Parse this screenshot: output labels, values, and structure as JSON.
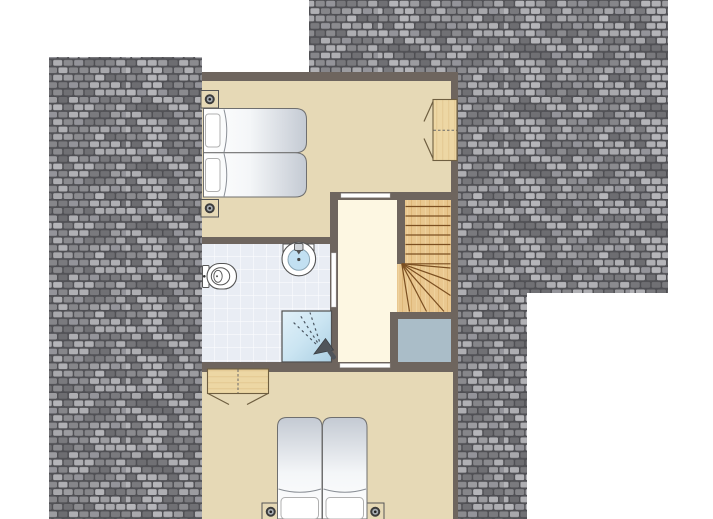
{
  "canvas": {
    "width": 713,
    "height": 519
  },
  "scene": {
    "type": "architectural-floor-plan",
    "description": "Top floor (attic) plan of a holiday house seen from above, surrounded by grey roof tiling. Two bedrooms, a bathroom, a landing and a winder staircase.",
    "rooms": [
      {
        "id": "bedroom-top",
        "label": "bedroom with two single beds and wardrobe"
      },
      {
        "id": "bathroom",
        "label": "bathroom with toilet, washbasin and shower"
      },
      {
        "id": "landing",
        "label": "landing / hallway"
      },
      {
        "id": "staircase",
        "label": "winder staircase going down"
      },
      {
        "id": "stairwell-void",
        "label": "stair void"
      },
      {
        "id": "bedroom-bottom",
        "label": "bedroom with double bed and wardrobe"
      }
    ],
    "furniture": [
      {
        "id": "twin-beds",
        "label": "two single beds side by side"
      },
      {
        "id": "wardrobe-top",
        "label": "wardrobe with open doors"
      },
      {
        "id": "toilet",
        "label": "toilet"
      },
      {
        "id": "washbasin",
        "label": "washbasin"
      },
      {
        "id": "shower",
        "label": "shower with spray symbol"
      },
      {
        "id": "wardrobe-bottom",
        "label": "wardrobe with open doors"
      },
      {
        "id": "double-bed",
        "label": "double bed (two mattresses)"
      },
      {
        "id": "spotlights",
        "label": "four ceiling spotlights"
      }
    ]
  },
  "colors": {
    "background": "#ffffff",
    "wall": "#6e655e",
    "bedroom_floor": "#e6d9b6",
    "landing_floor": "#fdf7e2",
    "bathroom_tile": "#e9edf4",
    "tile_grout": "#fbfcfe",
    "stair_wood": "#e9c78f",
    "stair_line": "#7b4f21",
    "wardrobe_wood": "#edd7a4",
    "wardrobe_grain": "#dcbc83",
    "wardrobe_edge": "#6f5f41",
    "shower_blue_light": "#e2f1f9",
    "shower_blue_dark": "#abcfe3",
    "sink_water": "#c2e0f2",
    "stairwell_void": "#aabdc8",
    "mattress_light": "#ffffff",
    "mattress_dark": "#c4cad3",
    "mattress_edge": "#6f6f6f",
    "pillow_edge": "#b0b0b0",
    "duvet_fold": "#8a8f96",
    "fixture_outline": "#555555",
    "door_opening": "#ffffff",
    "roof_gap": "#515156",
    "roof_tile_shades": [
      "#a8a8ac",
      "#8b8b8f",
      "#b5b5b9",
      "#77777b",
      "#9c9ca0",
      "#86868a",
      "#aeaeb2",
      "#707074",
      "#94949a",
      "#b0b0b4",
      "#7a7a7e",
      "#6d6d71"
    ]
  }
}
